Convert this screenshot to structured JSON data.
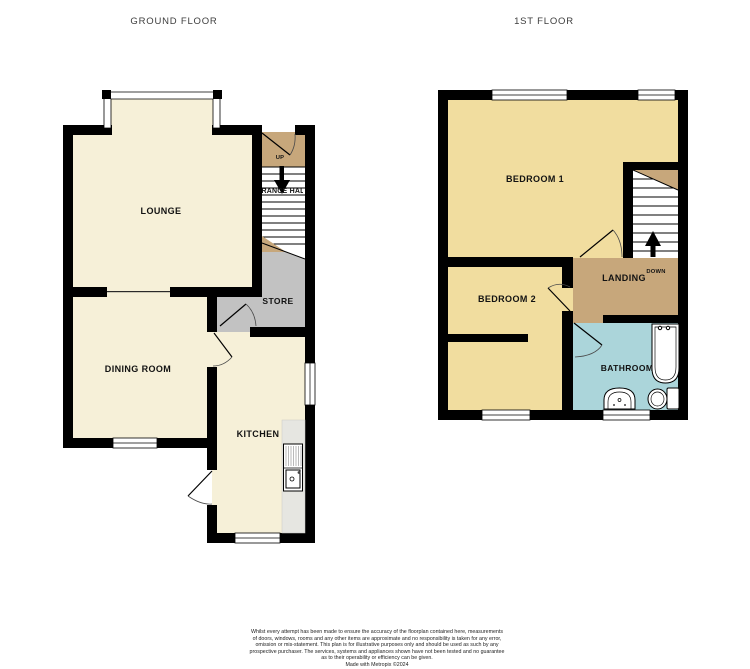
{
  "palette": {
    "wall": "#000000",
    "floor_cream": "#F6F0D8",
    "floor_yellow": "#F1DD9F",
    "floor_brown": "#C7A77B",
    "floor_gray": "#C2C2C2",
    "floor_blue": "#ABD5DA",
    "counter_gray": "#E6E6E1",
    "stairs_white": "#FFFFFF"
  },
  "floors": {
    "ground": {
      "title": "GROUND FLOOR",
      "rooms": {
        "lounge": "LOUNGE",
        "dining": "DINING ROOM",
        "kitchen": "KITCHEN",
        "store": "STORE",
        "hall": "ENTRANCE HALL"
      },
      "stairs_label": "UP"
    },
    "first": {
      "title": "1ST FLOOR",
      "rooms": {
        "bedroom1": "BEDROOM 1",
        "bedroom2": "BEDROOM 2",
        "landing": "LANDING",
        "bathroom": "BATHROOM"
      },
      "stairs_label": "DOWN"
    }
  },
  "disclaimer": {
    "lines": [
      "Whilst every attempt has been made to ensure the accuracy of the floorplan contained here, measurements",
      "of doors, windows, rooms and any other items are approximate and no responsibility is taken for any error,",
      "omission or mis-statement. This plan is for illustrative purposes only and should be used as such by any",
      "prospective purchaser. The services, systems and appliances shown have not been tested and no guarantee",
      "as to their operability or efficiency can be given."
    ],
    "made_with": "Made with Metropix ©2024"
  }
}
